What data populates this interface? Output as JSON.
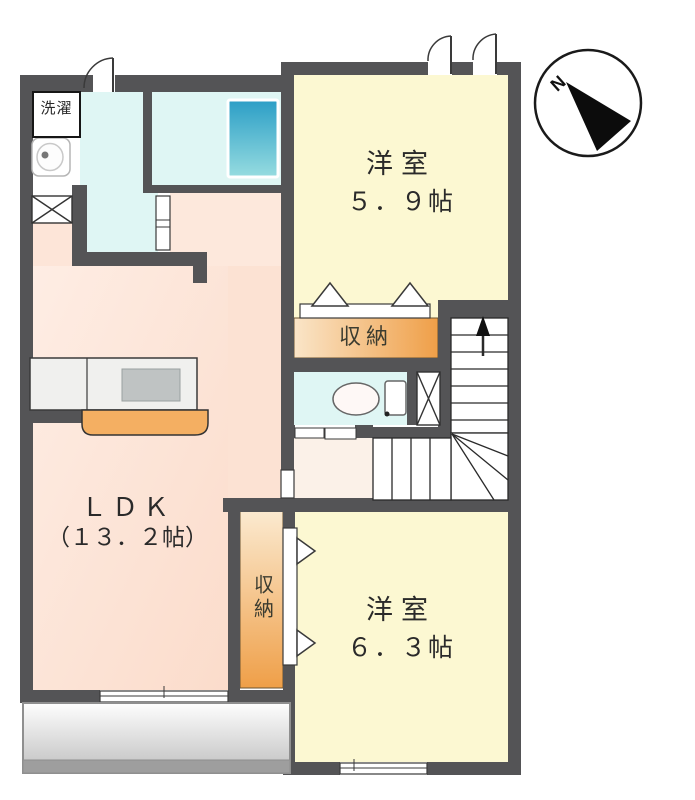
{
  "floorplan": {
    "compass": {
      "label": "N"
    },
    "laundry": {
      "label": "洗濯"
    },
    "bedroom1": {
      "label": "洋室",
      "size": "５．９帖"
    },
    "bedroom2": {
      "label": "洋室",
      "size": "６．３帖"
    },
    "ldk": {
      "label": "ＬＤＫ",
      "size": "（１３．２帖）"
    },
    "closet_upper": {
      "label": "収納"
    },
    "closet_lower": {
      "label": "収納"
    },
    "colors": {
      "wall": "#545456",
      "bedroom_fill": "#FCF8D2",
      "ldk_fill": "#FBDFD1",
      "wet_area_fill": "#DFF6F4",
      "hall_fill": "#FBF1E8",
      "closet_gradient_start": "#FBE9CF",
      "closet_gradient_end": "#EF9F48",
      "kitchen_counter": "#F4AF62",
      "bathtub_gradient_start": "#2B9EC6",
      "bathtub_gradient_end": "#96DCE0",
      "balcony_gray": "#BFBFBF"
    }
  }
}
